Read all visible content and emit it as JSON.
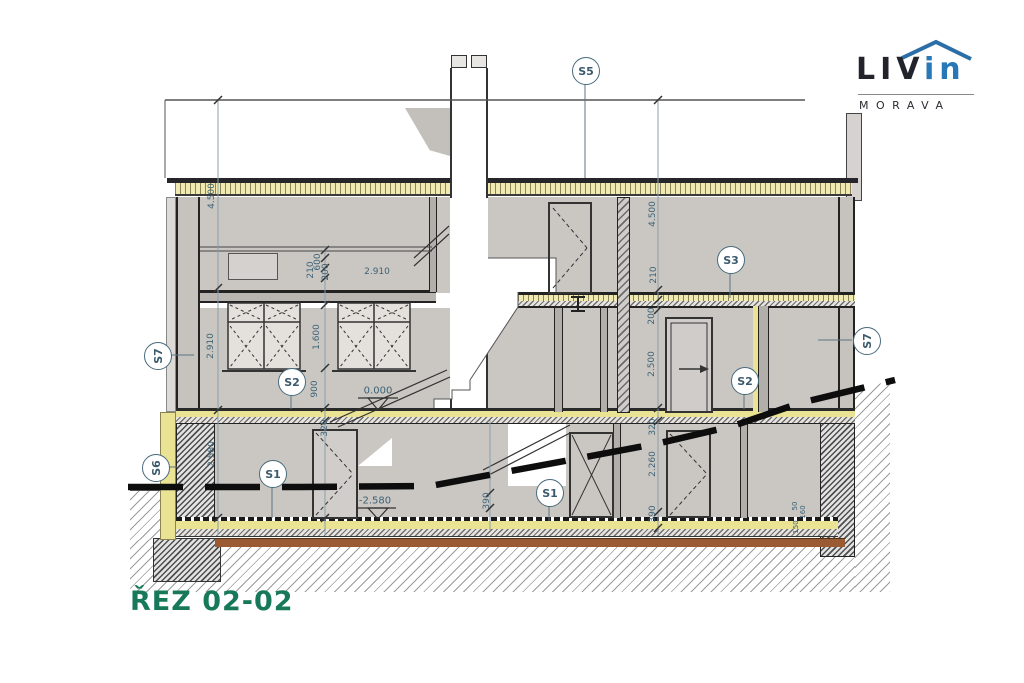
{
  "logo": {
    "brand_black": "LIV",
    "brand_blue": "in",
    "subtitle": "MORAVA"
  },
  "title": "ŘEZ 02-02",
  "section_markers": {
    "s5": "S5",
    "s3": "S3",
    "s7a": "S7",
    "s7b": "S7",
    "s2a": "S2",
    "s2b": "S2",
    "s6": "S6",
    "s1a": "S1",
    "s1b": "S1"
  },
  "levels": {
    "ground": "0.000",
    "basement": "-2.580"
  },
  "dimensions": {
    "left_chain": [
      "4.500",
      "2.910",
      "2.580"
    ],
    "inner_chain": [
      "210",
      "600",
      "200",
      "1.600",
      "900",
      "320"
    ],
    "right_chain": [
      "4.500",
      "210",
      "200",
      "2.500",
      "320",
      "2.260",
      "390"
    ],
    "mid_chain": [
      "390"
    ],
    "headroom": "2.910",
    "detail_right": [
      "50",
      "160",
      "150"
    ]
  },
  "colors": {
    "accent_green": "#17795a",
    "brand_blue": "#2878b8",
    "insulation_yellow": "#eae394",
    "dimension_blue": "#3d6275"
  }
}
